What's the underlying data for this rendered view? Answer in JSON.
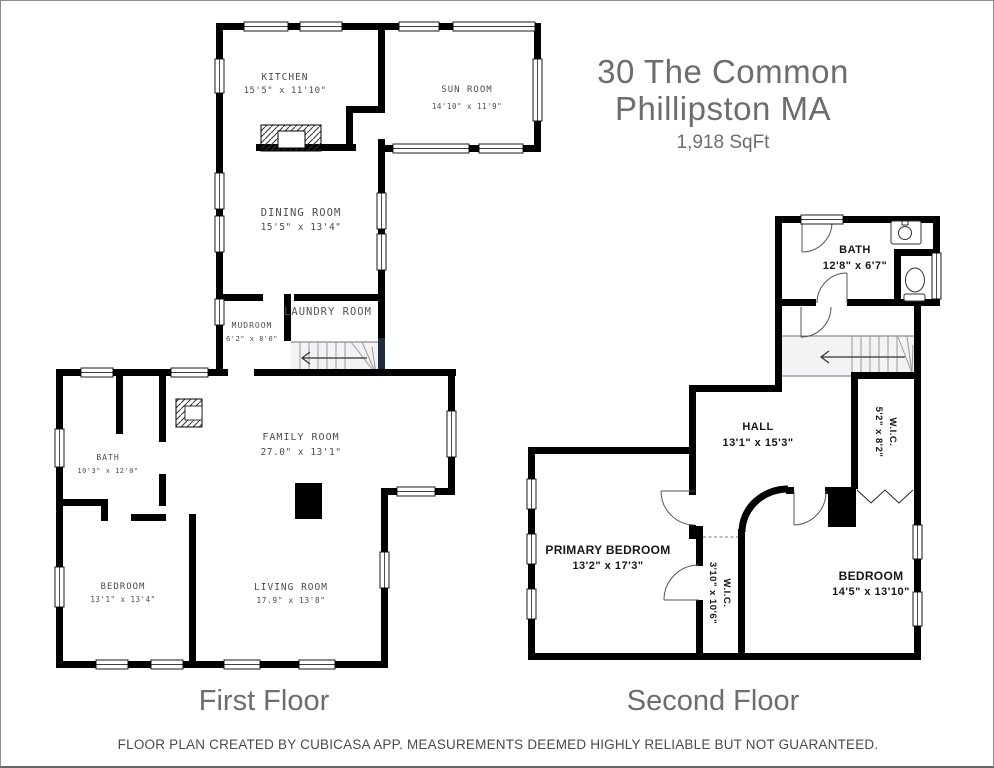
{
  "header": {
    "address_line1": "30 The Common",
    "address_line2": "Phillipston MA",
    "area": "1,918 SqFt"
  },
  "first_floor": {
    "label": "First Floor",
    "rooms": [
      {
        "name": "KITCHEN",
        "dims": "15'5\" x 11'10\""
      },
      {
        "name": "SUN ROOM",
        "dims": "14'10\" x 11'9\""
      },
      {
        "name": "DINING ROOM",
        "dims": "15'5\" x 13'4\""
      },
      {
        "name": "MUDROOM",
        "dims": "6'2\" x 8'0\""
      },
      {
        "name": "LAUNDRY ROOM",
        "dims": ""
      },
      {
        "name": "BATH",
        "dims": "10'3\" x 12'0\""
      },
      {
        "name": "FAMILY ROOM",
        "dims": "27.0\" x 13'1\""
      },
      {
        "name": "BEDROOM",
        "dims": "13'1\" x 13'4\""
      },
      {
        "name": "LIVING ROOM",
        "dims": "17.9\" x 13'8\""
      }
    ]
  },
  "second_floor": {
    "label": "Second Floor",
    "rooms": [
      {
        "name": "BATH",
        "dims": "12'8\" x 6'7\""
      },
      {
        "name": "HALL",
        "dims": "13'1\" x 15'3\""
      },
      {
        "name": "W.I.C.",
        "dims": "5'2\" x 8'2\""
      },
      {
        "name": "PRIMARY BEDROOM",
        "dims": "13'2\" x 17'3\""
      },
      {
        "name": "W.I.C.",
        "dims": "3'10\" x 10'6\""
      },
      {
        "name": "BEDROOM",
        "dims": "14'5\" x 13'10\""
      }
    ]
  },
  "footer": {
    "disclaimer": "FLOOR PLAN CREATED BY CUBICASA APP. MEASUREMENTS DEEMED HIGHLY RELIABLE BUT NOT GUARANTEED."
  }
}
